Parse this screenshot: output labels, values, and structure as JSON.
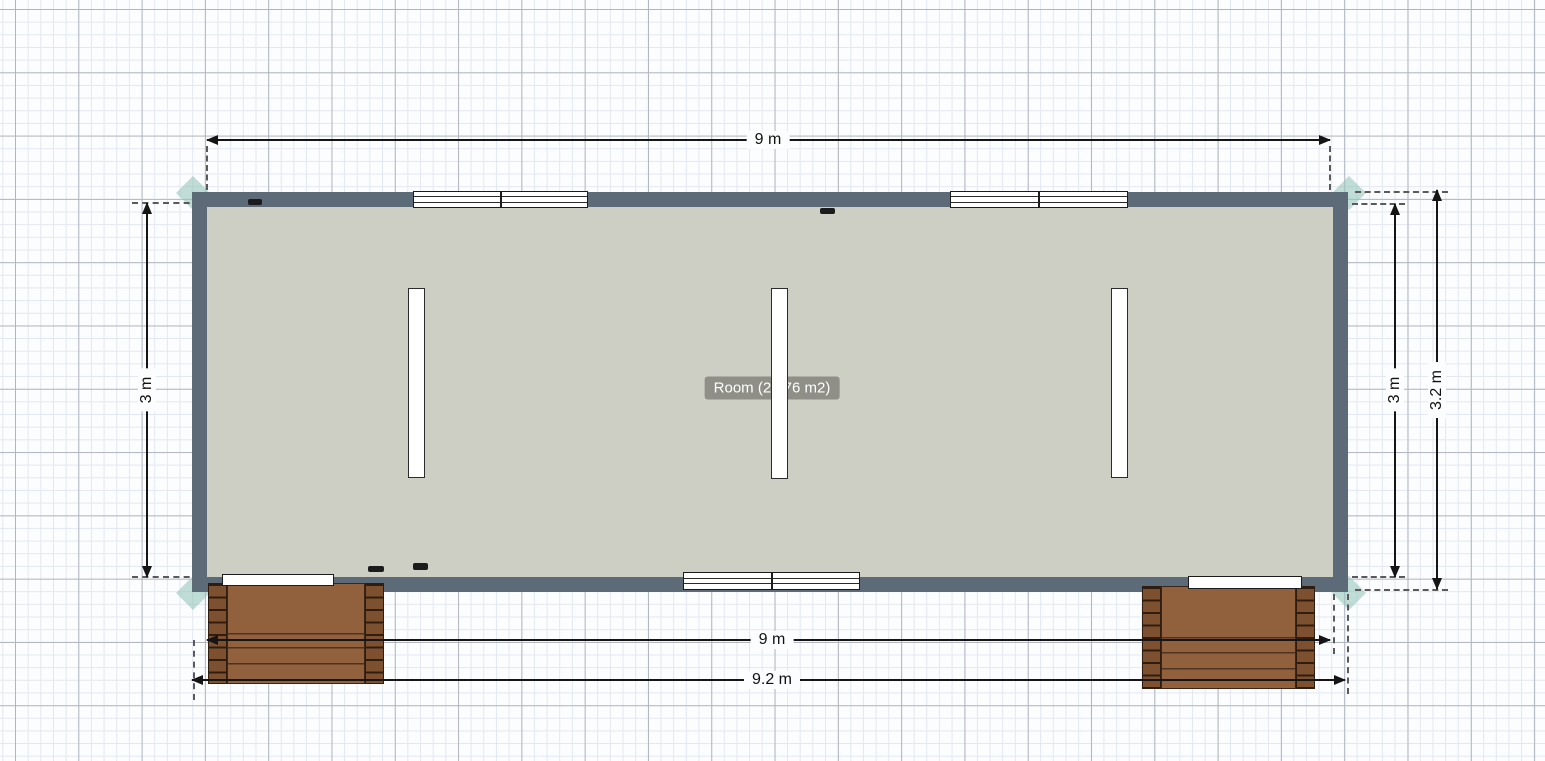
{
  "app": {
    "view": "floor-plan-editor-canvas"
  },
  "room": {
    "label": "Room (26.76 m2)"
  },
  "dimensions": {
    "top_width": "9 m",
    "left_height": "3 m",
    "right_inner_height": "3 m",
    "right_outer_height": "3.2 m",
    "bottom_inner_width": "9 m",
    "bottom_outer_width": "9.2 m"
  },
  "elements": {
    "top_window_count": 2,
    "bottom_window_count": 1,
    "door_count": 2,
    "wall_panel_count": 3,
    "deck_count": 2,
    "outlet_mark_count": 4
  },
  "colors": {
    "wall": "#5c6b77",
    "floor": "#cdcec4",
    "corner_accent": "rgba(150,198,186,0.6)",
    "deck_wood": "#91613d",
    "deck_rail": "#7d512f",
    "deck_line": "#4f3320",
    "dim": "#151515",
    "grid_minor": "#e3e7f1",
    "grid_major": "#b1b5c0",
    "label_bg": "rgba(105,105,98,0.62)",
    "label_text": "#ffffff"
  }
}
